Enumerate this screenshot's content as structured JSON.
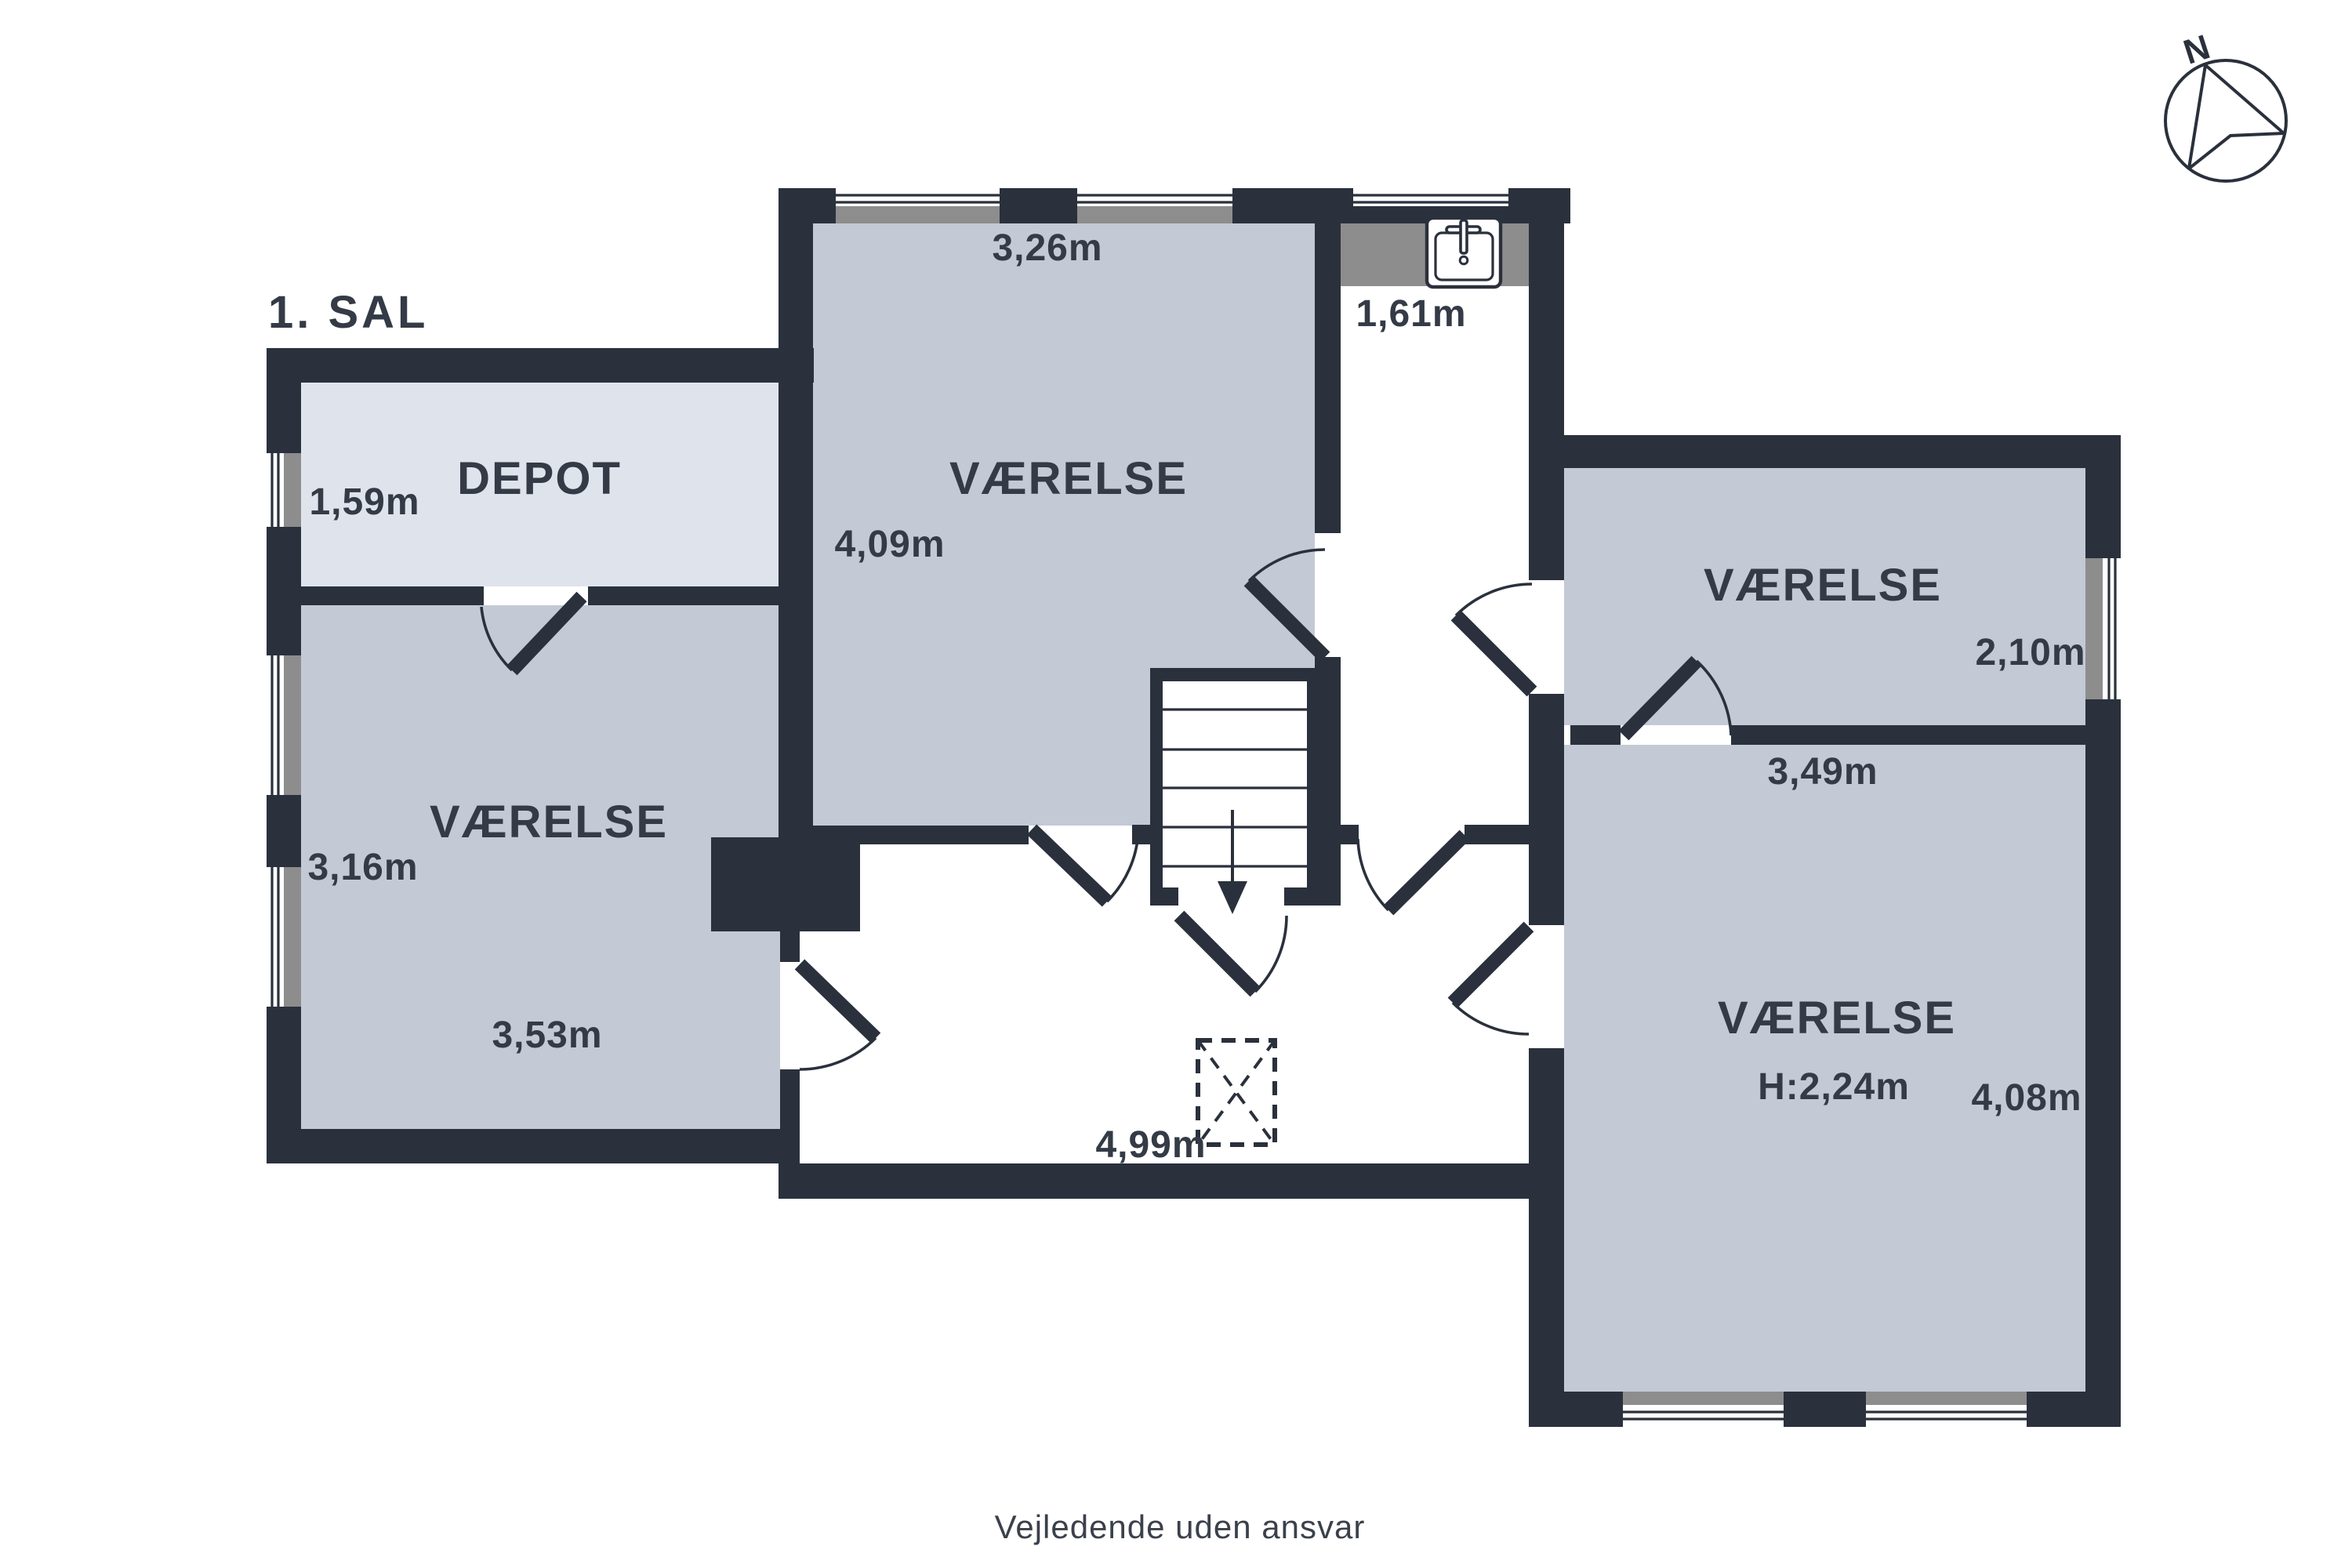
{
  "title": "1. SAL",
  "compass": {
    "label": "N"
  },
  "rooms": {
    "depot": {
      "name": "DEPOT",
      "dim_width": "1,59m"
    },
    "left": {
      "name": "VÆRELSE",
      "dim_width": "3,16m",
      "dim_length": "3,53m"
    },
    "center": {
      "name": "VÆRELSE",
      "dim_top": "3,26m",
      "dim_side": "4,09m"
    },
    "top_right": {
      "name": "VÆRELSE",
      "dim_side": "2,10m",
      "dim_bottom": "3,49m"
    },
    "bottom_right": {
      "name": "VÆRELSE",
      "dim_height": "H:2,24m",
      "dim_side": "4,08m"
    }
  },
  "hallway": {
    "dim_sink_nook": "1,61m",
    "dim_width": "4,99m"
  },
  "footer": "Vejledende uden ansvar",
  "icons": {
    "sink": "sink-icon",
    "compass": "compass-north-icon",
    "stairs": "stairs-down-arrow-icon"
  },
  "colors": {
    "wall": "#2a313c",
    "room_fill": "#c3c9d5",
    "depot_fill": "#dfe3ec",
    "window_face_gray": "#8d8d8d",
    "text": "#343b46",
    "background": "#ffffff"
  }
}
